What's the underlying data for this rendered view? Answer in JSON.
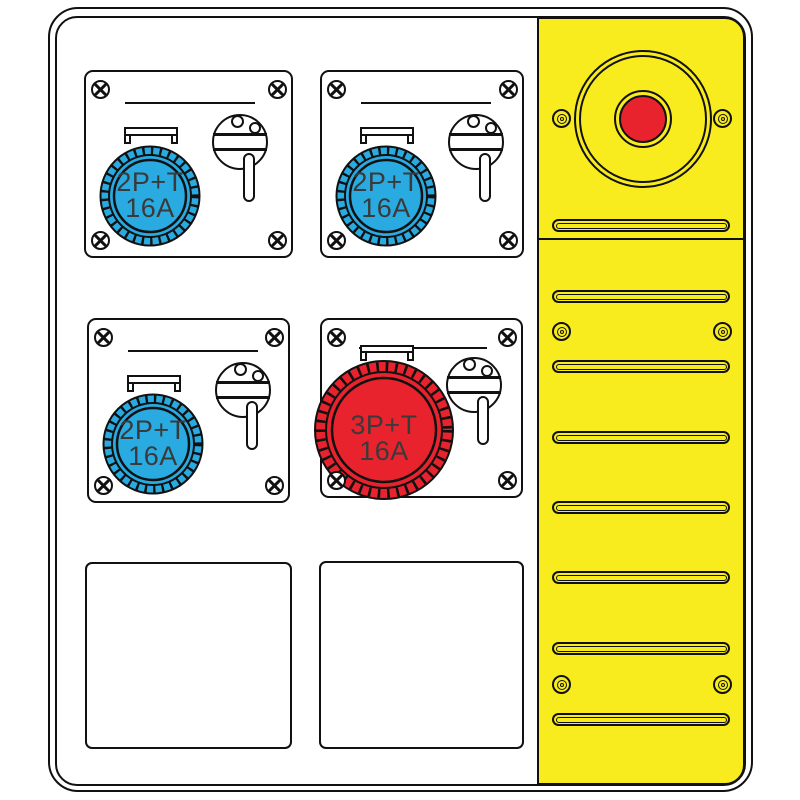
{
  "modules": [
    {
      "name": "socket-module-top-left",
      "socket_label_line1": "2P+T",
      "socket_label_line2": "16A",
      "socket_color": "#29abe2"
    },
    {
      "name": "socket-module-top-right",
      "socket_label_line1": "2P+T",
      "socket_label_line2": "16A",
      "socket_color": "#29abe2"
    },
    {
      "name": "socket-module-bottom-left",
      "socket_label_line1": "2P+T",
      "socket_label_line2": "16A",
      "socket_color": "#29abe2"
    },
    {
      "name": "socket-module-bottom-middle",
      "socket_label_line1": "3P+T",
      "socket_label_line2": "16A",
      "socket_color": "#e8232d"
    }
  ],
  "right_panel": {
    "color": "#f8ec1e",
    "estop_button_color": "#e8232d",
    "vent_slot_count": 8,
    "screw_pair_count": 3
  },
  "colors": {
    "outline": "#111111",
    "label_text": "#3a3a3a",
    "module_background": "#ffffff"
  }
}
